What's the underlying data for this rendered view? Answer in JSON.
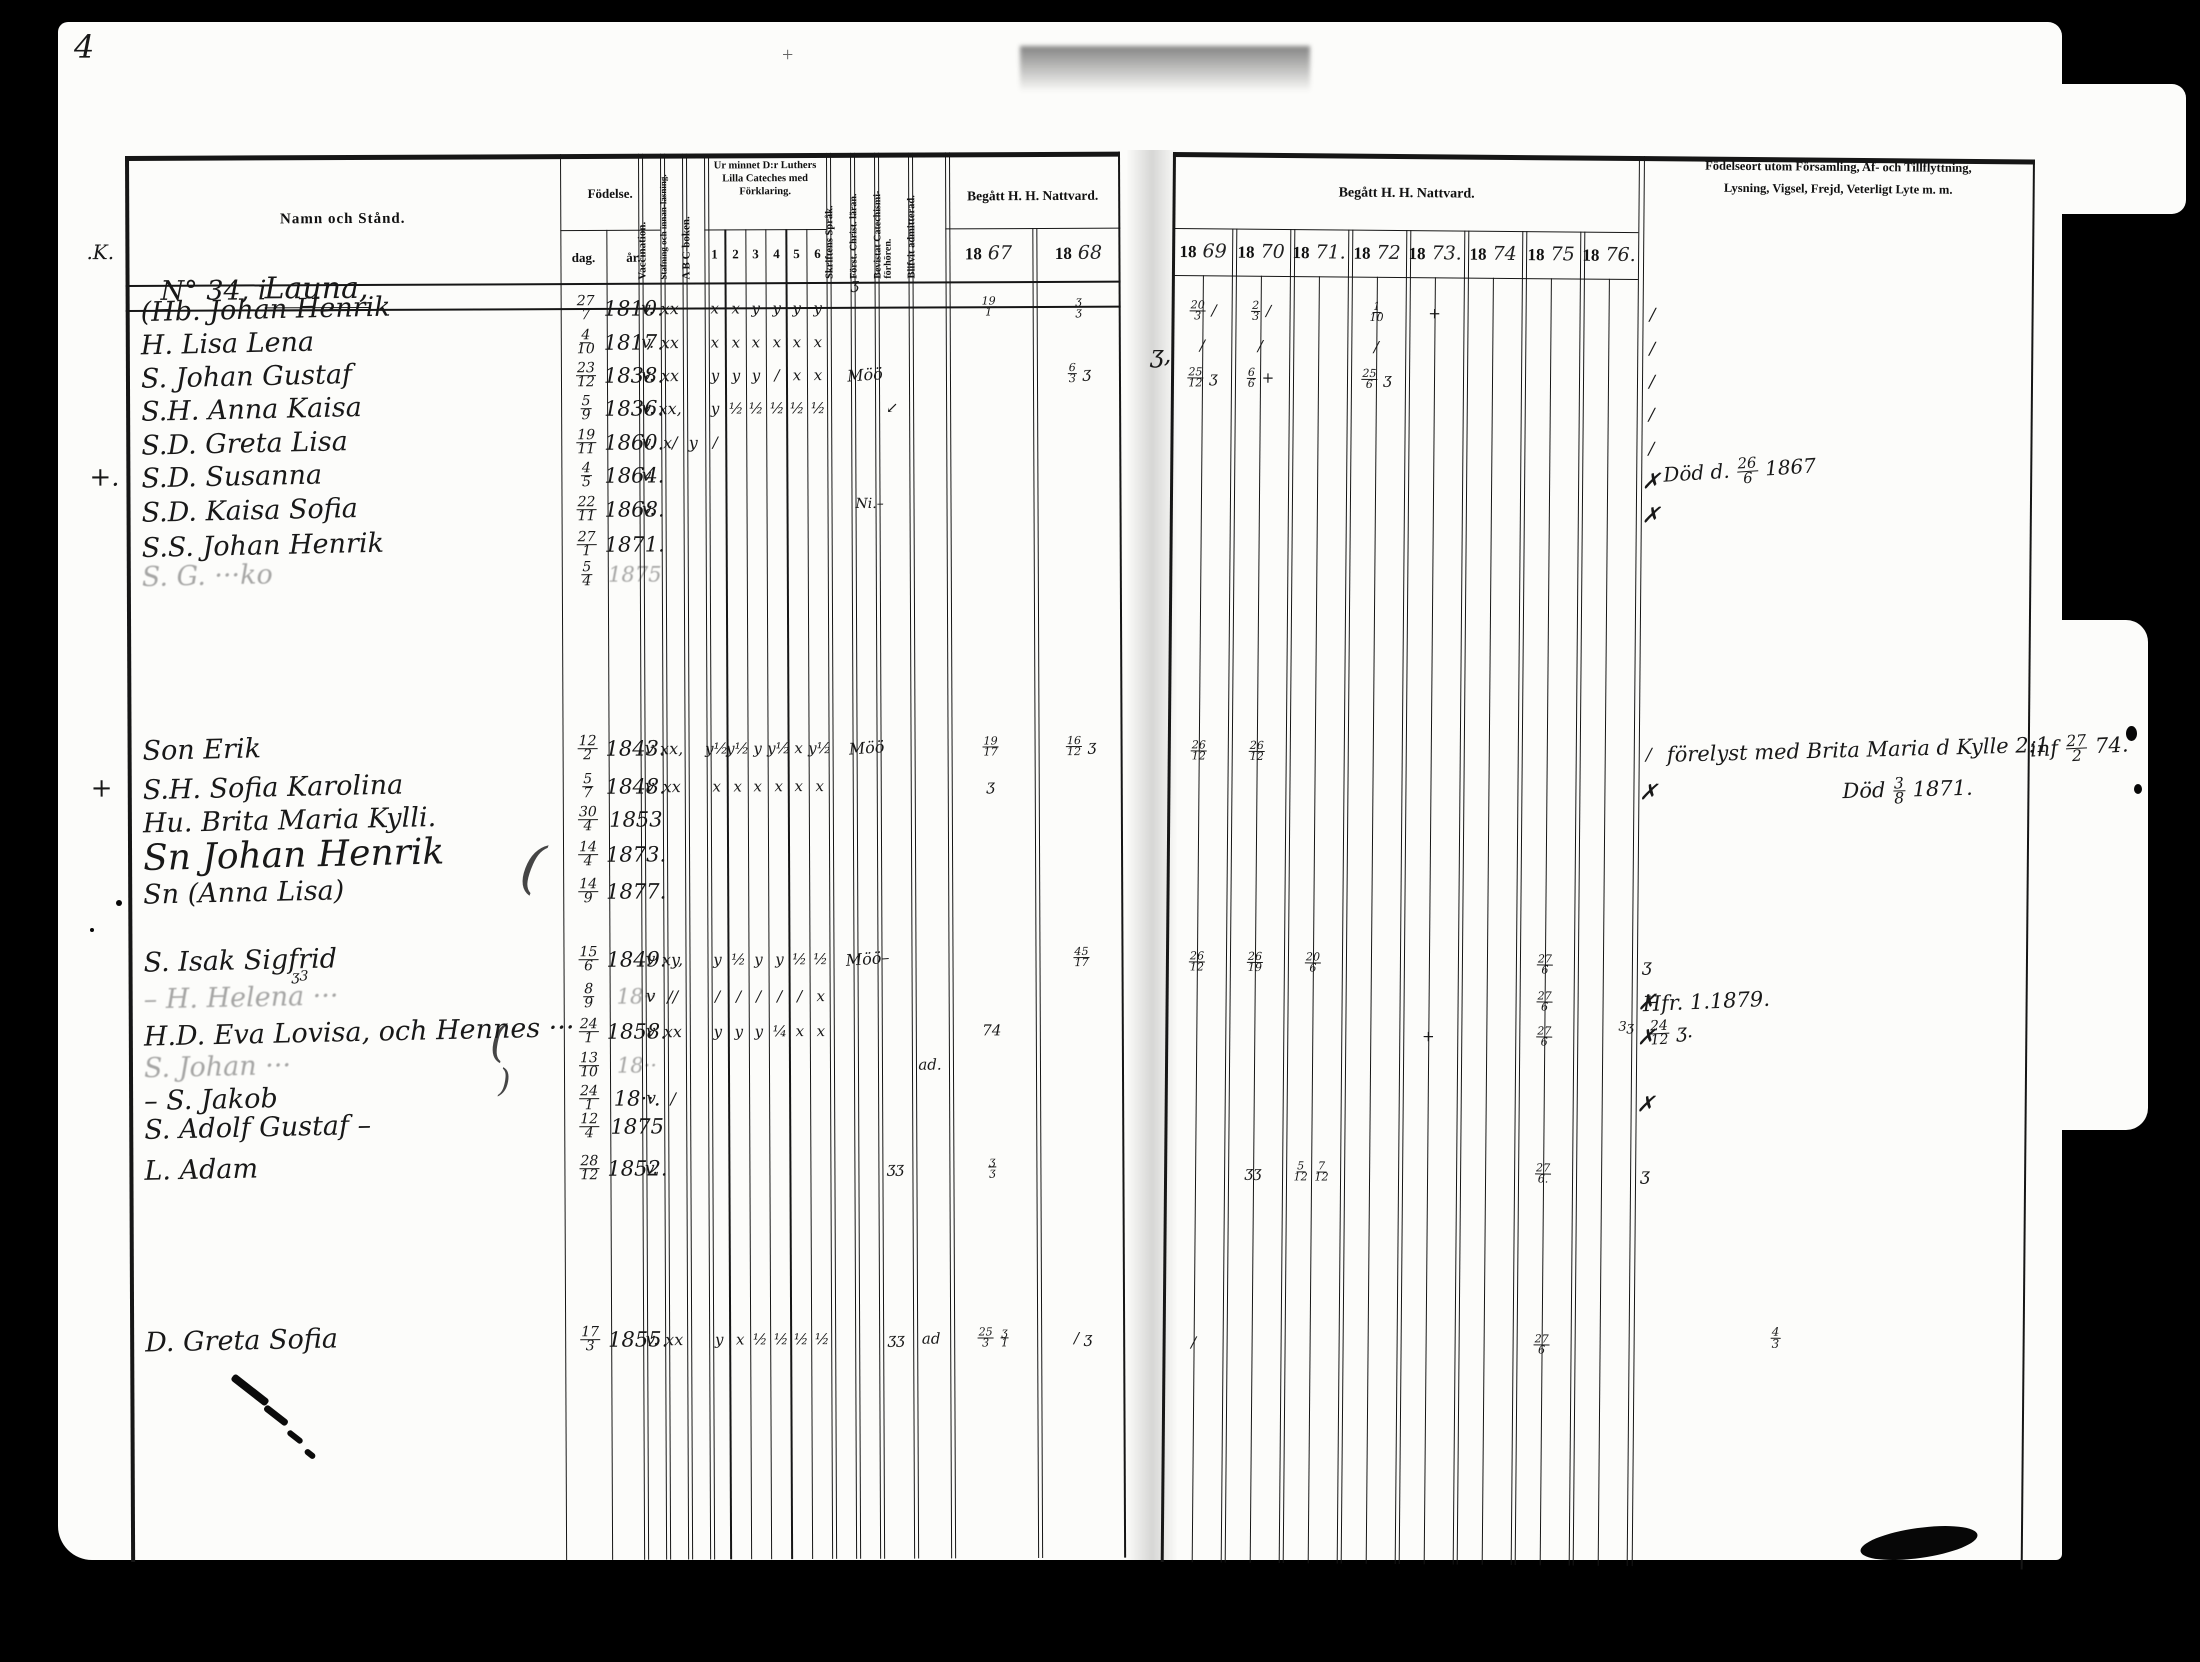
{
  "page": {
    "number": "4"
  },
  "left_table": {
    "headers": {
      "name": "Namn och Stånd.",
      "birth": "Födelse.",
      "birth_day": "dag.",
      "birth_year": "år.",
      "vaccination": "Vaccination.",
      "spelling": "Stafning och innan-läsning.",
      "abc": "A B C-boken.",
      "catechism": "Ur minnet D:r Luthers Lilla Cateches med Förklaring.",
      "catechism_cols": [
        "1",
        "2",
        "3",
        "4",
        "5",
        "6"
      ],
      "scripture": "Skriftens Språk.",
      "christianity": "Först. Christ. läran.",
      "attended": "Bevistat Catechismi-förhören.",
      "admitted": "Blifvit admitterad.",
      "communion": "Begått H. H. Nattvard.",
      "years": [
        {
          "printed": "18",
          "written": "67"
        },
        {
          "printed": "18",
          "written": "68"
        }
      ]
    },
    "household": {
      "margin": ".K.",
      "number": "N° 34, i",
      "village": "Launa,"
    }
  },
  "right_table": {
    "communion": "Begått H. H. Nattvard.",
    "years": [
      {
        "printed": "18",
        "written": "69"
      },
      {
        "printed": "18",
        "written": "70"
      },
      {
        "printed": "18",
        "written": "71."
      },
      {
        "printed": "18",
        "written": "72"
      },
      {
        "printed": "18",
        "written": "73."
      },
      {
        "printed": "18",
        "written": "74"
      },
      {
        "printed": "18",
        "written": "75"
      },
      {
        "printed": "18",
        "written": "76."
      }
    ],
    "notes_header_line1": "Födelseort utom Församling, Af- och Tillflyttning,",
    "notes_header_line2": "Lysning, Vigsel, Frejd, Veterligt Lyte m. m."
  },
  "rows": [
    {
      "name": "(Hb. Johan Henrik",
      "dag": "27/7",
      "ar": "1810.",
      "vacc": "v.",
      "read": "xx",
      "cat": [
        "x",
        "x",
        "y",
        "y",
        "y",
        "y"
      ],
      "y67": "19/1",
      "y68": "ʒ/ʒ",
      "y69": "20/3 /",
      "y70": "2/3 /",
      "y72": "1/10",
      "y73": "+",
      "rm": "/"
    },
    {
      "name": "H. Lisa Lena",
      "dag": "4/10",
      "ar": "1817.",
      "vacc": "v.",
      "read": "xx",
      "cat": [
        "x",
        "x",
        "x",
        "x",
        "x",
        "x"
      ],
      "y69": "/",
      "y70": "/",
      "y72": "/",
      "rm": "/"
    },
    {
      "name": "S. Johan Gustaf",
      "dag": "23/12",
      "ar": "1838.",
      "vacc": "v.",
      "read": "xx",
      "cat": [
        "y",
        "y",
        "y",
        "/",
        "x",
        "x"
      ],
      "christ": "Möö",
      "y68": "6/3 ʒ",
      "y69": "25/12 ʒ",
      "y70": "6/6 +",
      "y72": "25/6 ʒ",
      "rm": "/"
    },
    {
      "name": "S.H. Anna Kaisa",
      "dag": "5/9",
      "ar": "1836.",
      "vacc": "v.",
      "read": "xx,",
      "cat": [
        "y",
        "½",
        "½",
        "½",
        "½",
        "½"
      ],
      "bev": "↙",
      "rm": "/"
    },
    {
      "name": "S.D. Greta Lisa",
      "dag": "19/11",
      "ar": "1860.",
      "vacc": "v.",
      "read": "x/",
      "abc": "y",
      "cat": [
        "/",
        "",
        "",
        "",
        "",
        ""
      ],
      "rm": "/"
    },
    {
      "margin": "+.",
      "name": "S.D. Susanna",
      "dag": "4/5",
      "ar": "1864.",
      "vacc": "v.",
      "rm": "✗"
    },
    {
      "name": "S.D. Kaisa Sofia",
      "dag": "22/11",
      "ar": "1868.",
      "vacc": "v.",
      "rm": "✗"
    },
    {
      "name": "S.S. Johan Henrik",
      "dag": "27/1",
      "ar": "1871."
    },
    {
      "name": "S. G. ···ko",
      "faint": true,
      "dag": "5/4",
      "ar": "1875"
    },
    {
      "name": "Son Erik",
      "dag": "12/2",
      "ar": "1843.",
      "vacc": "v",
      "read": "xx,",
      "cat": [
        "y½",
        "y½",
        "y",
        "y½",
        "x",
        "y½"
      ],
      "christ": "Möö",
      "y67": "19/17",
      "y68": "16/12 ʒ",
      "y69": "26/12",
      "y70": "26/12",
      "rm": "/"
    },
    {
      "margin": "+",
      "name": "S.H. Sofia Karolina",
      "dag": "5/7",
      "ar": "1848.",
      "vacc": "v",
      "read": "xx",
      "cat": [
        "x",
        "x",
        "x",
        "x",
        "x",
        "x"
      ],
      "y67": "ʒ",
      "rm": "✗"
    },
    {
      "name": "Hu. Brita Maria Kylli.",
      "dag": "30/4",
      "ar": "1853"
    },
    {
      "name": "Sn Johan Henrik",
      "big": true,
      "dag": "14/4",
      "ar": "1873."
    },
    {
      "name": "Sn (Anna Lisa)",
      "dag": "14/9",
      "ar": "1877."
    },
    {
      "name": "S. Isak Sigfrid",
      "dag": "15/6",
      "ar": "1849.",
      "vacc": "v",
      "read": "xy,",
      "cat": [
        "y",
        "½",
        "y",
        "y",
        "½",
        "½"
      ],
      "christ": "Möö–",
      "y68": "45/17",
      "y69": "26/12",
      "y70": "26/19",
      "y71": "20/6",
      "y75": "27/6",
      "rm": "ʒ"
    },
    {
      "name": "– H. Helena ···",
      "faint": true,
      "dag": "8/9",
      "ar": "18··",
      "vacc": "v",
      "read": "//",
      "cat": [
        "/",
        "/",
        "/",
        "/",
        "/",
        "x"
      ],
      "y75": "27/6",
      "rm": "✗"
    },
    {
      "name": "H.D. Eva Lovisa, och Hennes ···",
      "dag": "24/1",
      "ar": "1858.",
      "vacc": "v",
      "read": "xx",
      "cat": [
        "y",
        "y",
        "y",
        "¼",
        "x",
        "x"
      ],
      "y67": "74",
      "y73": "+",
      "y75": "27/6",
      "rm": "✗"
    },
    {
      "name": "S. Johan ···",
      "faint": true,
      "dag": "13/10",
      "ar": "18··",
      "adm": "ad."
    },
    {
      "name": "– S. Jakob",
      "dag": "24/1",
      "ar": "18··.",
      "vacc": "v",
      "read": "/",
      "rm": "✗"
    },
    {
      "name": "S. Adolf Gustaf –",
      "dag": "12/4",
      "ar": "1875"
    },
    {
      "name": "L. Adam",
      "dag": "28/12",
      "ar": "1852.",
      "vacc": "v.",
      "bev": "ʒʒ",
      "y67": "ʒ/ʒ",
      "y70": "ʒʒ",
      "y71": "5/12 7/12",
      "y75": "27/6.",
      "rm": "ʒ"
    },
    {
      "name": "D. Greta Sofia",
      "dag": "17/3",
      "ar": "1855.",
      "vacc": "v.",
      "read": "xx",
      "cat": [
        "y",
        "x",
        "½",
        "½",
        "½",
        "½"
      ],
      "bev": "ʒʒ",
      "adm": "ad",
      "y67": "25/3 ʒ/1",
      "y68": "/ ʒ",
      "y69": "/",
      "y75": "27/6"
    }
  ],
  "annotations": [
    {
      "text": "Död d. 26/6 1867"
    },
    {
      "text": "förelyst med Brita Maria d Kylle 2:1"
    },
    {
      "text": "Död 3/8 1871."
    },
    {
      "text": "inf 27/2 74."
    },
    {
      "text": "Hfr. 1.1879."
    },
    {
      "text": "24/12 ʒ."
    },
    {
      "text": "3ʒ"
    },
    {
      "text": "4/3"
    },
    {
      "text": "Ni.–"
    },
    {
      "text": "("
    },
    {
      "text": "ʒ,"
    },
    {
      "text": "("
    },
    {
      "text": ")"
    },
    {
      "text": "ʒ3"
    },
    {
      "text": "ʒ"
    }
  ]
}
